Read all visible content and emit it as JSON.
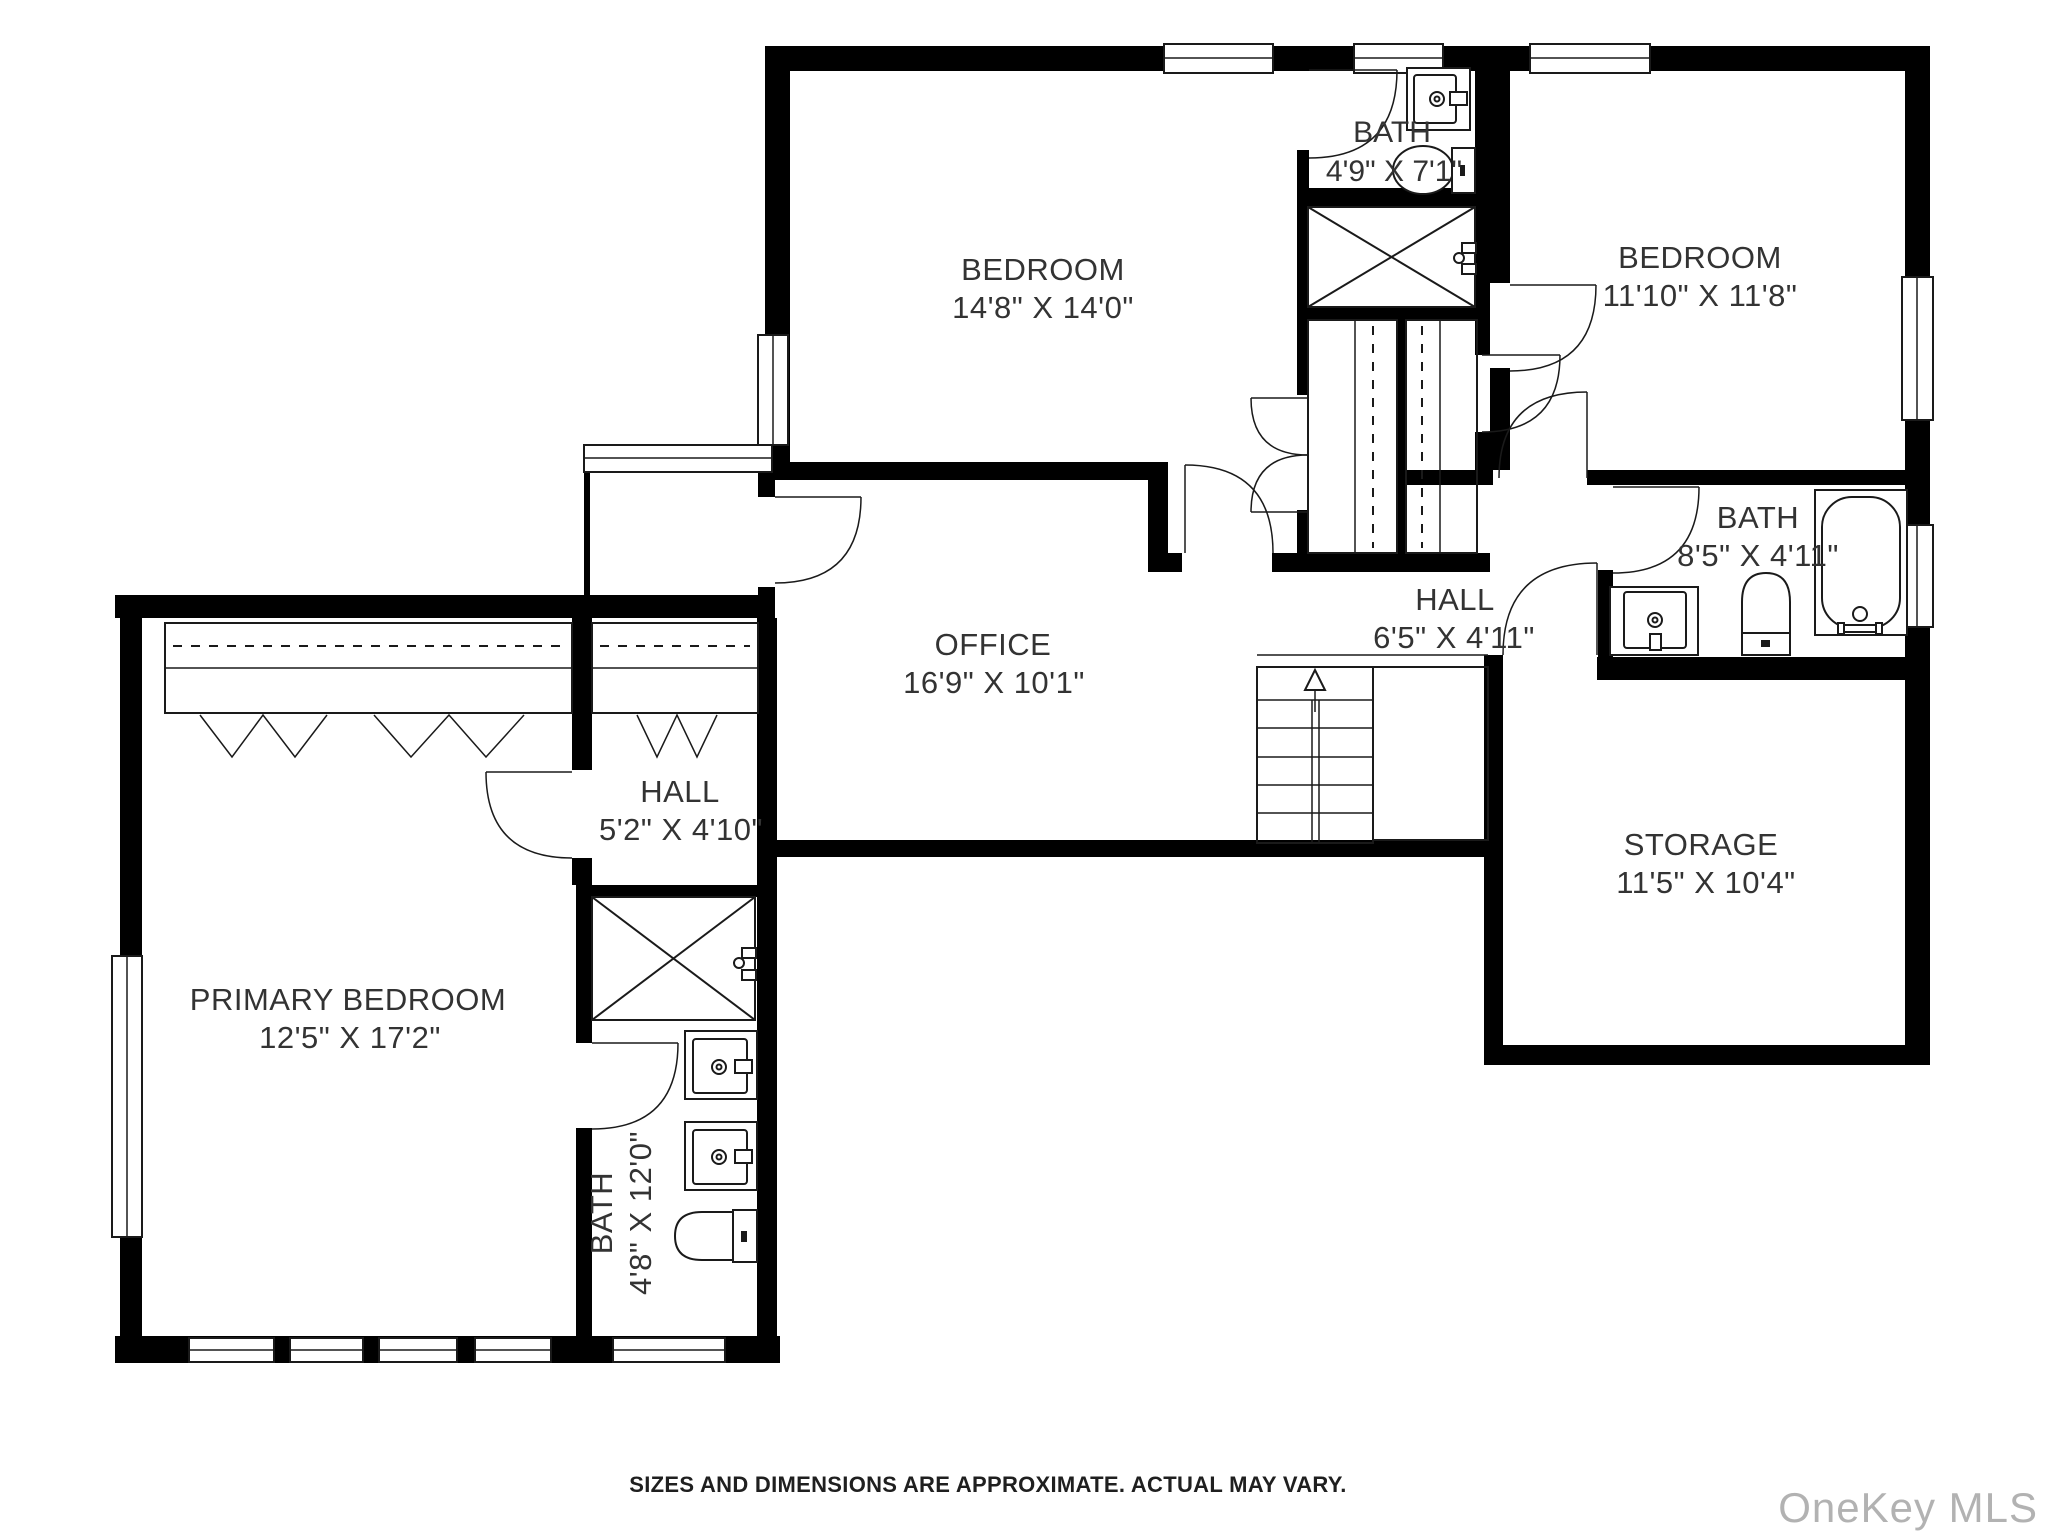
{
  "plan": {
    "rooms": [
      {
        "id": "bedroom-1",
        "name": "BEDROOM",
        "dims": "14'8\" X 14'0\""
      },
      {
        "id": "bath-top",
        "name": "BATH",
        "dims": "4'9\" X 7'1\""
      },
      {
        "id": "bedroom-2",
        "name": "BEDROOM",
        "dims": "11'10\" X 11'8\""
      },
      {
        "id": "bath-right",
        "name": "BATH",
        "dims": "8'5\" X 4'11\""
      },
      {
        "id": "hall-upper",
        "name": "HALL",
        "dims": "6'5\" X 4'11\""
      },
      {
        "id": "office",
        "name": "OFFICE",
        "dims": "16'9\" X 10'1\""
      },
      {
        "id": "hall-lower",
        "name": "HALL",
        "dims": "5'2\" X 4'10\""
      },
      {
        "id": "primary-bedroom",
        "name": "PRIMARY BEDROOM",
        "dims": "12'5\" X 17'2\""
      },
      {
        "id": "bath-primary",
        "name": "BATH",
        "dims": "4'8\" X 12'0\""
      },
      {
        "id": "storage",
        "name": "STORAGE",
        "dims": "11'5\" X 10'4\""
      }
    ],
    "footer": {
      "disclaimer": "SIZES AND DIMENSIONS ARE APPROXIMATE. ACTUAL MAY VARY."
    },
    "watermark": "OneKey MLS",
    "colors": {
      "wall": "#000000",
      "line": "#1a1a1a",
      "background": "#ffffff",
      "label_text": "#333333",
      "watermark_text": "#b2b2b2"
    }
  }
}
